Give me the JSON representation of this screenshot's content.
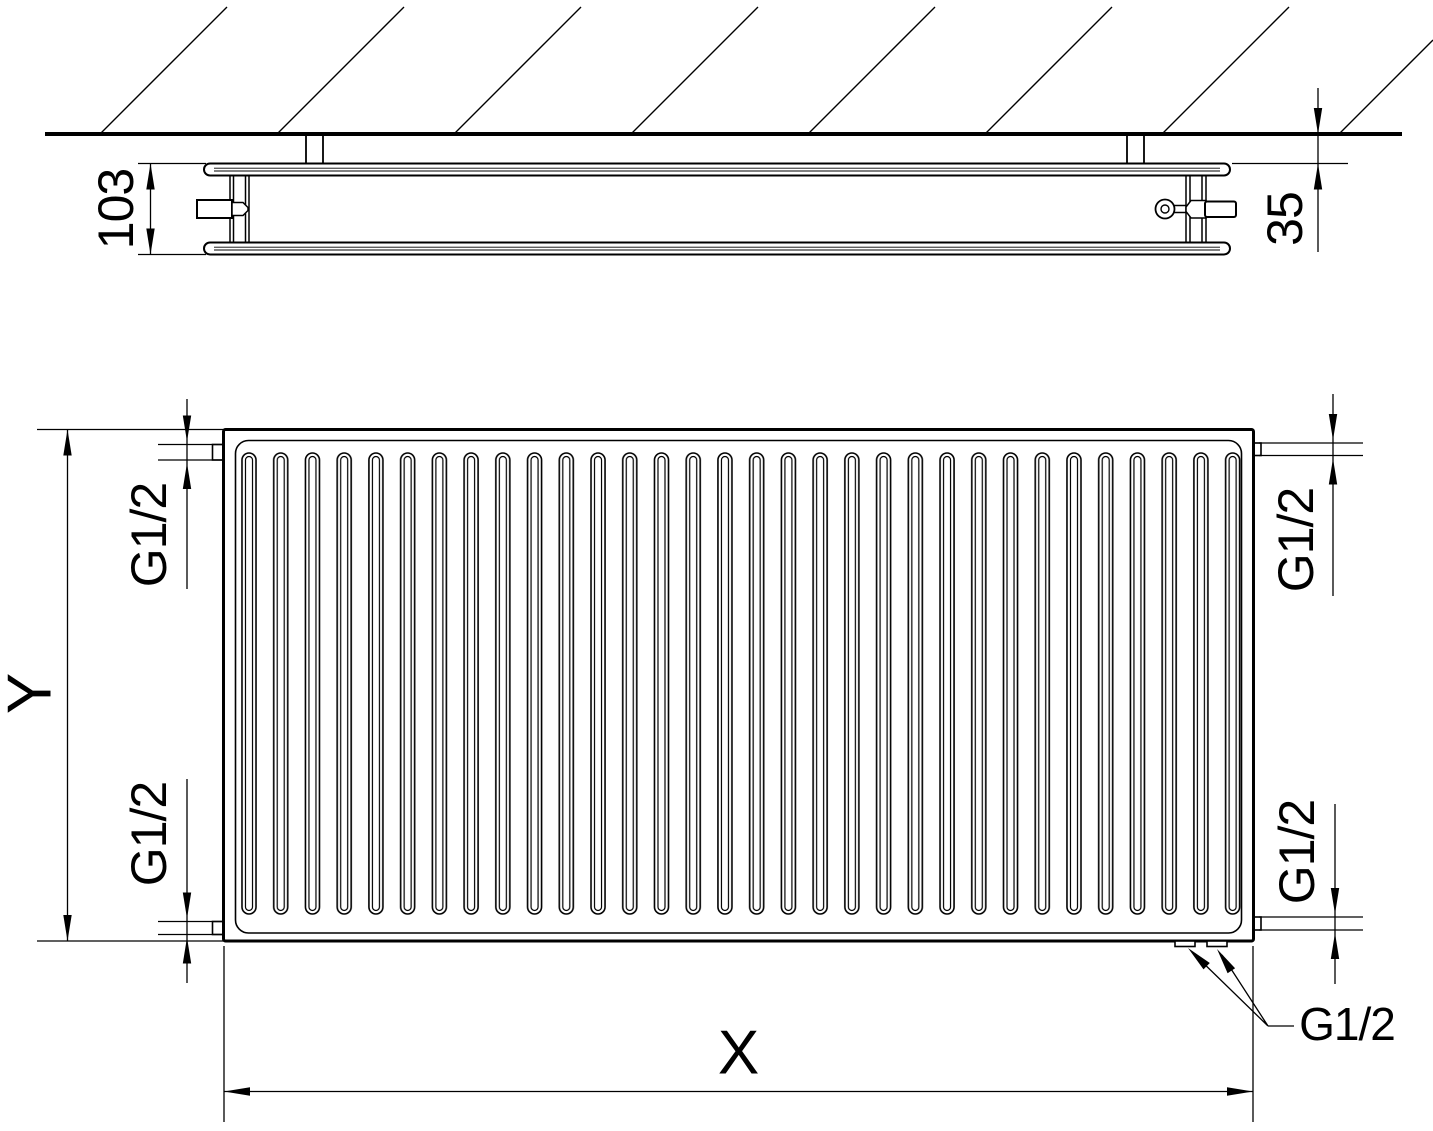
{
  "drawing": {
    "colors": {
      "line": "#000000",
      "background": "#ffffff"
    },
    "top_view": {
      "depth": "103",
      "wall_distance": "35"
    },
    "front_view": {
      "height": "Y",
      "width": "X",
      "connection_top_left": "G1/2",
      "connection_bottom_left": "G1/2",
      "connection_top_right": "G1/2",
      "connection_bottom_right": "G1/2",
      "bottom_connections": "G1/2"
    }
  }
}
